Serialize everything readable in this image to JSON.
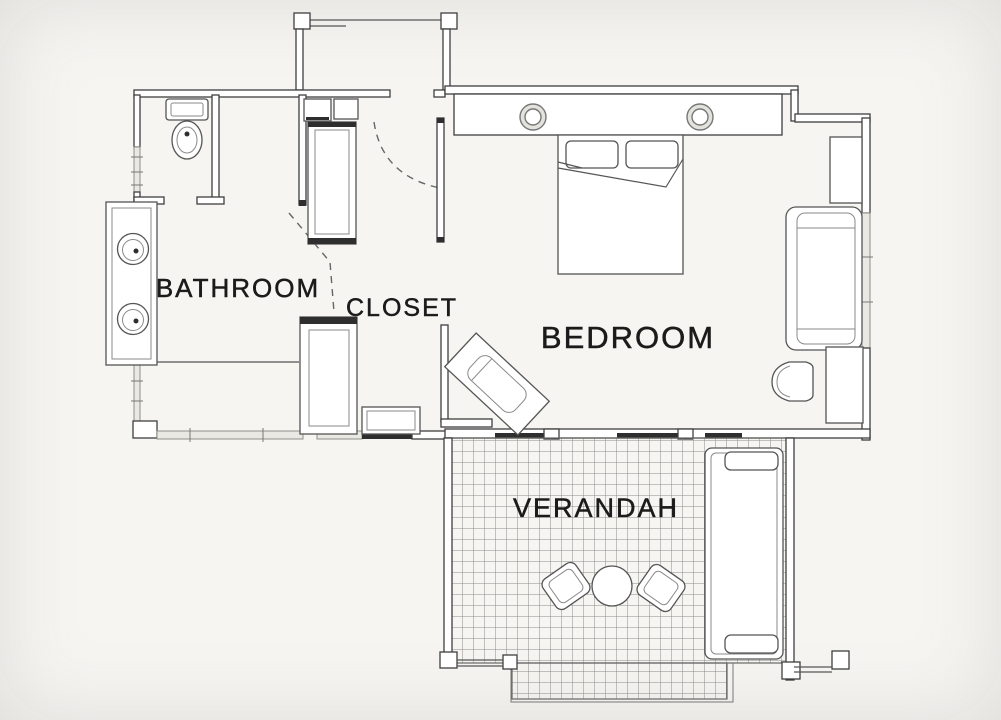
{
  "rooms": {
    "bathroom": {
      "label": "BATHROOM"
    },
    "closet": {
      "label": "CLOSET"
    },
    "bedroom": {
      "label": "BEDROOM"
    },
    "verandah": {
      "label": "VERANDAH"
    }
  },
  "colors": {
    "background": "#f6f5f2",
    "wall_line": "#3f3f3f",
    "furniture_line": "#555555",
    "window_fill": "#e9e8e3",
    "hatch_line": "#8a8a8a",
    "dark_fill": "#2e2e2e",
    "label_text": "#1b1b1b"
  },
  "elements": [
    "entry-porch",
    "entry-door-swing",
    "toilet",
    "vanity-two-sinks",
    "upper-wardrobe",
    "lower-wardrobe",
    "closet-cabinets",
    "closet-bench",
    "closet-door-swing",
    "double-bed",
    "pillows",
    "headboard-shelf",
    "headboard-sconces",
    "side-table",
    "sofa",
    "armchair",
    "luggage-bench",
    "sliding-doors",
    "deck-grid",
    "round-table",
    "deck-chair",
    "lounger",
    "railing",
    "deck-step",
    "windows",
    "posts"
  ]
}
